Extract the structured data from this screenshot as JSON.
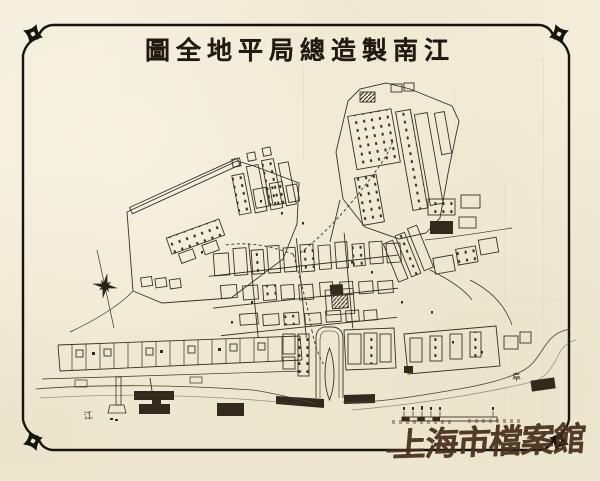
{
  "document": {
    "title": "圖全地平局總造製南江"
  },
  "map": {
    "labels": {
      "river": "江",
      "bank": "阜"
    }
  },
  "stamp": {
    "text": "上海市檔案館"
  },
  "colors": {
    "paper": "#f2ecd8",
    "ink": "#3a3126",
    "frame": "#17130d",
    "stamp_ink": "#452e1b",
    "fold": "#e6dfc7"
  }
}
